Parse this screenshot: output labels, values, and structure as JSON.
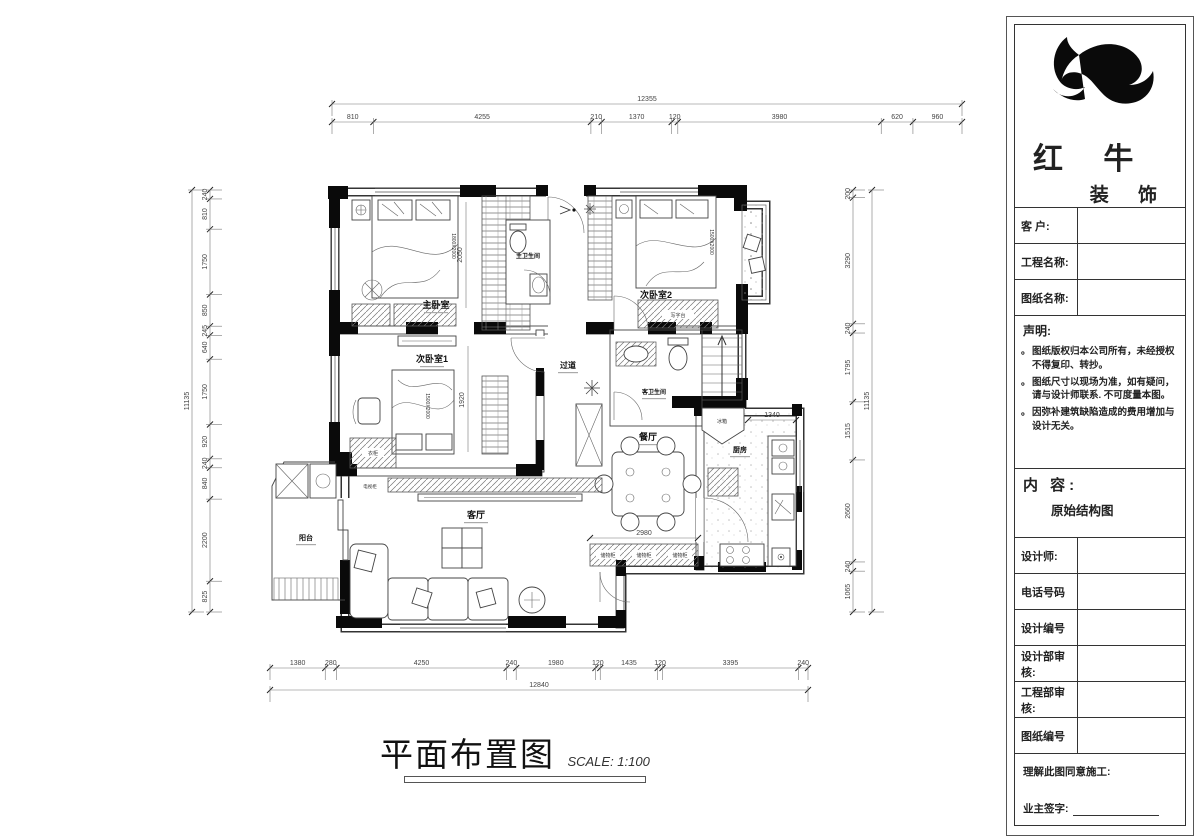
{
  "brand": {
    "name_main": "红 牛",
    "name_sub": "装 饰"
  },
  "titleblock": {
    "fields_top": [
      {
        "label": "客  户:"
      },
      {
        "label": "工程名称:"
      },
      {
        "label": "图纸名称:"
      }
    ],
    "statement": {
      "title": "声明:",
      "items": [
        "图纸版权归本公司所有，未经授权不得复印、转抄。",
        "图纸尺寸以现场为准，如有疑问，请与设计师联系. 不可度量本图。",
        "因弥补建筑缺陷造成的费用增加与设计无关。"
      ]
    },
    "content": {
      "label": "内 容:",
      "value": "原始结构图"
    },
    "fields_bottom": [
      {
        "label": "设计师:"
      },
      {
        "label": "电话号码"
      },
      {
        "label": "设计编号"
      },
      {
        "label": "设计部审核:"
      },
      {
        "label": "工程部审核:"
      },
      {
        "label": "图纸编号"
      }
    ],
    "footer": {
      "line1": "理解此图同意施工:",
      "line2": "业主签字:"
    }
  },
  "drawing_title": {
    "text": "平面布置图",
    "scale": "SCALE: 1:100"
  },
  "rooms": {
    "master_bedroom": "主卧室",
    "bedroom2": "次卧室2",
    "bedroom1": "次卧室1",
    "hallway": "过道",
    "master_bath": "主卫生间",
    "guest_bath": "客卫生间",
    "living": "客厅",
    "dining": "餐厅",
    "kitchen": "厨房",
    "balcony": "阳台"
  },
  "furniture": {
    "fridge": "冰箱",
    "desk": "写字台",
    "tv_cabinet": "电视柜",
    "storage_cabinet": "储物柜",
    "wardrobe": "衣柜",
    "bed_master": "1800X2000",
    "bed_secondary": "1500X2000"
  },
  "dimensions": {
    "top": {
      "total": "12355",
      "segments": [
        "810",
        "4255",
        "210",
        "1370",
        "120",
        "3980",
        "620",
        "960"
      ]
    },
    "bottom": {
      "total": "12840",
      "segments": [
        "1380",
        "280",
        "4250",
        "240",
        "1980",
        "120",
        "1435",
        "120",
        "3395",
        "240"
      ]
    },
    "left": {
      "total": "11135",
      "segments": [
        "240",
        "810",
        "1750",
        "850",
        "245",
        "640",
        "1750",
        "920",
        "240",
        "840",
        "2200",
        "825"
      ]
    },
    "right": {
      "total": "11135",
      "segments": [
        "200",
        "3290",
        "240",
        "1795",
        "1515",
        "2660",
        "240",
        "1065"
      ]
    },
    "inner": {
      "master": "2050",
      "bedroom1": "1920",
      "living": "2980",
      "kitchen": "1340"
    }
  }
}
